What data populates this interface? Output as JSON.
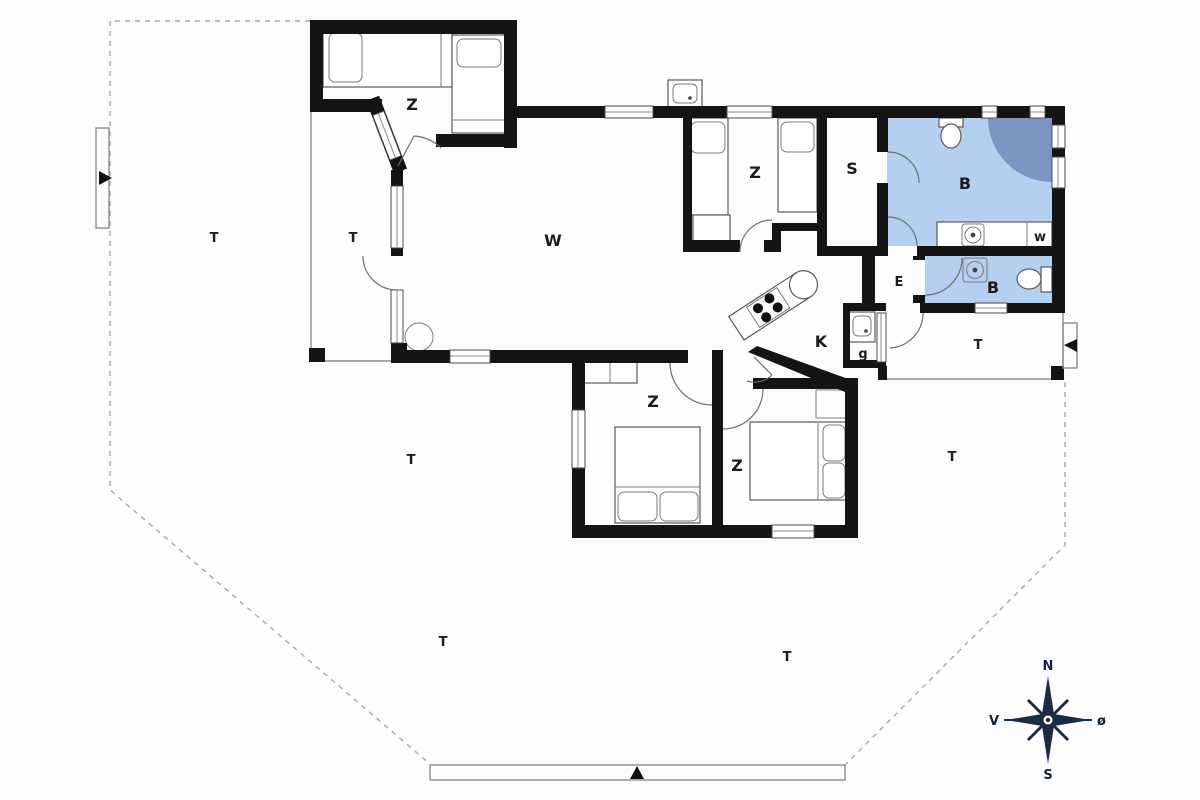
{
  "title": "Holiday house floor plan",
  "labels": {
    "bedroom": "Z",
    "living": "W",
    "sauna": "S",
    "bath": "B",
    "hall": "E",
    "kitchen": "K",
    "utility": "g",
    "washer": "w",
    "terrace": "T"
  },
  "compass": {
    "north": "N",
    "south": "S",
    "west": "V",
    "east": "ø"
  },
  "colors": {
    "wall": "#141414",
    "bath_fill": "#b5cfee",
    "shower_fill": "#7d95c5",
    "compass": "#1d2b45"
  }
}
